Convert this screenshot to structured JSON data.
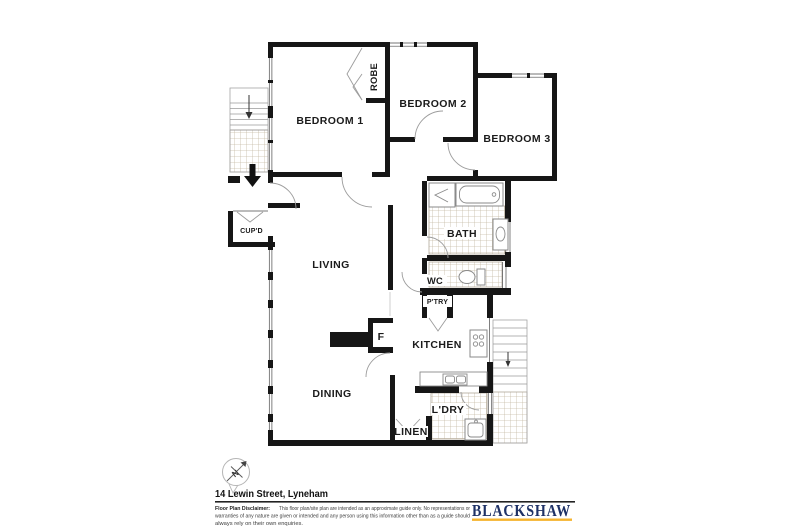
{
  "floor_plan": {
    "room_labels": {
      "bedroom1": "BEDROOM 1",
      "bedroom2": "BEDROOM 2",
      "bedroom3": "BEDROOM 3",
      "robe": "ROBE",
      "bath": "BATH",
      "wc": "WC",
      "pantry": "P'TRY",
      "kitchen": "KITCHEN",
      "living": "LIVING",
      "dining": "DINING",
      "fridge": "F",
      "laundry": "L'DRY",
      "linen": "LINEN",
      "cupboard": "CUP'D"
    }
  },
  "compass": {
    "north_label": "N"
  },
  "footer": {
    "address": "14 Lewin Street, Lyneham",
    "disclaimer_label": "Floor Plan Disclaimer:",
    "disclaimer_lines": [
      "This floor plan/site plan are intended as an approximate guide only. No representations or",
      "warranties of any nature are given or intended and any person using this information other than as a guide should",
      "always rely on their own enquiries."
    ],
    "brand": "BLACKSHAW",
    "brand_color": "#1e3166",
    "brand_underline_color": "#f5b430"
  }
}
